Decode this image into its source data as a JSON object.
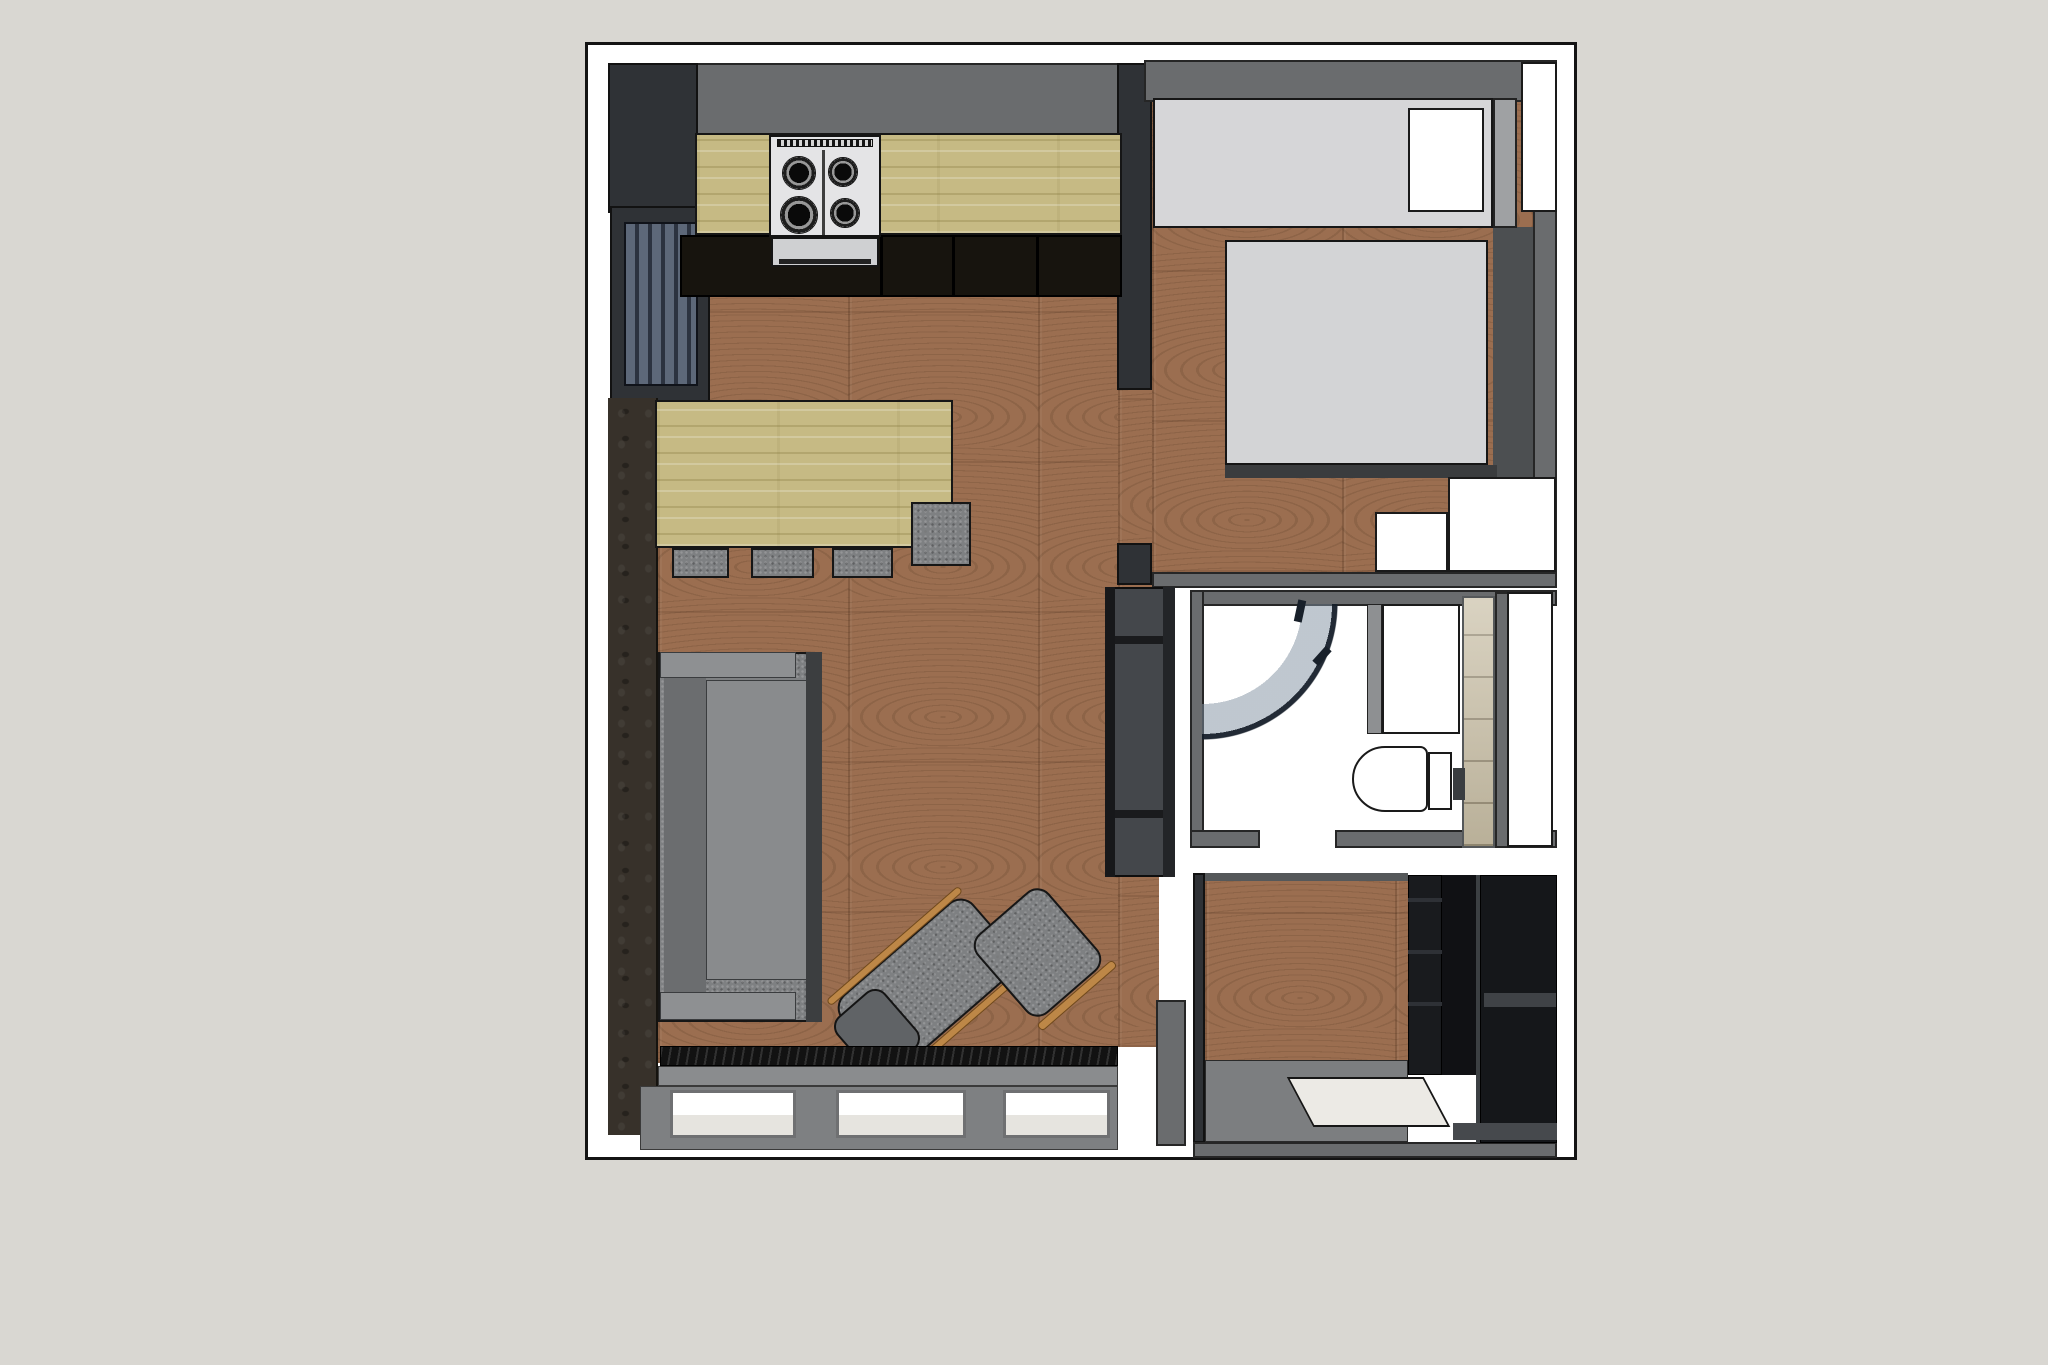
{
  "scene": {
    "kind": "apartment-floor-plan-3d-top-view",
    "rooms": [
      "kitchen",
      "living-room",
      "bedroom",
      "bathroom",
      "entry-hall"
    ],
    "furniture": [
      "kitchen-counter",
      "gas-stove",
      "dining-table",
      "stools",
      "sofa",
      "recliner-armchair",
      "ottoman",
      "tv-cabinet",
      "radiator",
      "windows",
      "closet",
      "bed",
      "nightstands",
      "shower",
      "vanity",
      "toilet",
      "shelving-unit",
      "doormat"
    ]
  },
  "canvas": {
    "width": 2048,
    "height": 1365,
    "background": "#d9d7d2"
  },
  "plan": {
    "x": 585,
    "y": 42,
    "w": 992,
    "h": 1118,
    "background": "#ffffff",
    "border": "#141414"
  },
  "palette": {
    "page_background": "#d9d7d2",
    "plan_background": "#ffffff",
    "wall_grey": "#6a6c6e",
    "wall_dark": "#2f3236",
    "floor_wood": "#9b6e50",
    "counter_wood": "#c6ba84",
    "fabric_grey": "#7e8082",
    "accent_wall_brown": "#37312a",
    "bed_grey": "#d3d4d6",
    "closet_grey": "#d6d6d8",
    "tile_beige": "#cdc4ad",
    "chair_wood_orange": "#bd8747",
    "outline_black": "#141414"
  },
  "elements": [
    {
      "name": "living-room-floor",
      "cls": "wood",
      "x": 658,
      "y": 297,
      "w": 460,
      "h": 766
    },
    {
      "name": "doorway-floor",
      "cls": "wood",
      "x": 1118,
      "y": 385,
      "w": 34,
      "h": 165
    },
    {
      "name": "doorway-floor-south",
      "cls": "wood",
      "x": 1118,
      "y": 550,
      "w": 34,
      "h": 40
    },
    {
      "name": "living-floor-entry-edge",
      "cls": "wood",
      "x": 1118,
      "y": 877,
      "w": 41,
      "h": 170
    },
    {
      "name": "bedroom-floor",
      "cls": "wood",
      "x": 1152,
      "y": 100,
      "w": 381,
      "h": 472
    },
    {
      "name": "entry-floor-wood",
      "cls": "wood",
      "x": 1205,
      "y": 878,
      "w": 203,
      "h": 186
    },
    {
      "name": "entry-floor-concrete",
      "x": 1205,
      "y": 1060,
      "w": 203,
      "h": 82,
      "fill": "#7c7e80",
      "border": "1px solid #2a2a2a"
    },
    {
      "name": "kitchen-top-wall",
      "cls": "wall",
      "x": 608,
      "y": 63,
      "w": 536,
      "h": 72
    },
    {
      "name": "kitchen-corner-wall",
      "cls": "wall-dark",
      "x": 608,
      "y": 63,
      "w": 90,
      "h": 150
    },
    {
      "name": "left-window-frame",
      "cls": "wall-dark",
      "x": 610,
      "y": 206,
      "w": 100,
      "h": 196
    },
    {
      "name": "left-window-blinds",
      "cls": "blinds",
      "x": 624,
      "y": 222,
      "w": 74,
      "h": 164
    },
    {
      "name": "accent-wall",
      "cls": "accent",
      "x": 608,
      "y": 398,
      "w": 50,
      "h": 737
    },
    {
      "name": "partition-wall-upper",
      "cls": "wall-dark",
      "x": 1117,
      "y": 63,
      "w": 35,
      "h": 327
    },
    {
      "name": "partition-wall-stub",
      "cls": "wall-dark",
      "x": 1117,
      "y": 543,
      "w": 35,
      "h": 42
    },
    {
      "name": "bedroom-top-wall",
      "cls": "wall",
      "x": 1144,
      "y": 60,
      "w": 413,
      "h": 42
    },
    {
      "name": "bedroom-right-wall",
      "cls": "wall",
      "x": 1533,
      "y": 62,
      "w": 24,
      "h": 510
    },
    {
      "name": "bedroom-bottom-wall",
      "cls": "wall",
      "x": 1152,
      "y": 572,
      "w": 405,
      "h": 16
    },
    {
      "name": "bedroom-dark-floor-strip",
      "x": 1493,
      "y": 227,
      "w": 40,
      "h": 250,
      "fill": "#4c4f51"
    },
    {
      "name": "bathroom-top-wall",
      "cls": "wall",
      "x": 1190,
      "y": 590,
      "w": 367,
      "h": 16
    },
    {
      "name": "bathroom-left-wall",
      "cls": "wall",
      "x": 1190,
      "y": 590,
      "w": 14,
      "h": 258
    },
    {
      "name": "bathroom-bottom-wall-left",
      "cls": "wall",
      "x": 1190,
      "y": 830,
      "w": 70,
      "h": 18
    },
    {
      "name": "bathroom-bottom-wall-right",
      "cls": "wall",
      "x": 1335,
      "y": 830,
      "w": 222,
      "h": 18
    },
    {
      "name": "bathroom-right-sliver",
      "cls": "wall",
      "x": 1495,
      "y": 592,
      "w": 14,
      "h": 256
    },
    {
      "name": "entry-left-wall",
      "cls": "wall-dark",
      "x": 1193,
      "y": 873,
      "w": 12,
      "h": 270
    },
    {
      "name": "entry-top-wall",
      "x": 1205,
      "y": 873,
      "w": 203,
      "h": 8,
      "fill": "#55585a"
    },
    {
      "name": "entry-bottom-wall",
      "cls": "wall",
      "x": 1193,
      "y": 1142,
      "w": 364,
      "h": 16
    },
    {
      "name": "living-corner-wall",
      "cls": "wall",
      "x": 1156,
      "y": 1000,
      "w": 30,
      "h": 146
    },
    {
      "name": "kitchen-base-cabinets",
      "x": 680,
      "y": 235,
      "w": 442,
      "h": 62,
      "fill": "#17140e",
      "border": "2px solid #000"
    },
    {
      "name": "cabinet-divider-1",
      "x": 880,
      "y": 237,
      "w": 3,
      "h": 58,
      "fill": "#000"
    },
    {
      "name": "cabinet-divider-2",
      "x": 952,
      "y": 237,
      "w": 3,
      "h": 58,
      "fill": "#000"
    },
    {
      "name": "cabinet-divider-3",
      "x": 1036,
      "y": 237,
      "w": 3,
      "h": 58,
      "fill": "#000"
    },
    {
      "name": "kitchen-counter",
      "cls": "wood-light",
      "x": 695,
      "y": 133,
      "w": 427,
      "h": 102
    },
    {
      "name": "gas-stove",
      "x": 769,
      "y": 135,
      "w": 112,
      "h": 102,
      "fill": "#e4e4e6",
      "border": "2px solid #141414"
    },
    {
      "name": "stove-vent-strip",
      "cls": "vent",
      "x": 777,
      "y": 139,
      "w": 96,
      "h": 8
    },
    {
      "name": "burner-top-left",
      "cls": "burner",
      "x": 782,
      "y": 156,
      "w": 34,
      "h": 34
    },
    {
      "name": "burner-top-right",
      "cls": "burner",
      "x": 828,
      "y": 157,
      "w": 30,
      "h": 30
    },
    {
      "name": "burner-bottom-left",
      "cls": "burner",
      "x": 780,
      "y": 196,
      "w": 38,
      "h": 38
    },
    {
      "name": "burner-bottom-right",
      "cls": "burner",
      "x": 830,
      "y": 198,
      "w": 30,
      "h": 30
    },
    {
      "name": "stove-grate-divider",
      "x": 822,
      "y": 150,
      "w": 3,
      "h": 86,
      "fill": "rgba(20,20,20,0.8)"
    },
    {
      "name": "oven-front",
      "x": 771,
      "y": 237,
      "w": 108,
      "h": 30,
      "fill": "#cfd0d2",
      "border": "2px solid #141414"
    },
    {
      "name": "oven-handle",
      "x": 779,
      "y": 259,
      "w": 92,
      "h": 5,
      "fill": "#222"
    },
    {
      "name": "dining-table",
      "cls": "wood-light",
      "x": 655,
      "y": 400,
      "w": 298,
      "h": 148
    },
    {
      "name": "stool-1",
      "cls": "fabric",
      "x": 672,
      "y": 548,
      "w": 57,
      "h": 30
    },
    {
      "name": "stool-2",
      "cls": "fabric",
      "x": 751,
      "y": 548,
      "w": 63,
      "h": 30
    },
    {
      "name": "stool-3",
      "cls": "fabric",
      "x": 832,
      "y": 548,
      "w": 61,
      "h": 30
    },
    {
      "name": "stool-4",
      "cls": "fabric",
      "x": 911,
      "y": 502,
      "w": 60,
      "h": 64
    },
    {
      "name": "sofa",
      "cls": "fabric",
      "x": 658,
      "y": 652,
      "w": 164,
      "h": 370
    },
    {
      "name": "sofa-back-cushion",
      "x": 664,
      "y": 662,
      "w": 42,
      "h": 348,
      "fill": "#6b6d6f"
    },
    {
      "name": "sofa-seat",
      "x": 706,
      "y": 680,
      "w": 104,
      "h": 300,
      "fill": "#898b8d",
      "border": "1px solid #3a3c3e"
    },
    {
      "name": "sofa-armrest-top",
      "x": 660,
      "y": 652,
      "w": 136,
      "h": 26,
      "fill": "#8e9092",
      "border": "1px solid #3a3c3e"
    },
    {
      "name": "sofa-armrest-bottom",
      "x": 660,
      "y": 992,
      "w": 136,
      "h": 28,
      "fill": "#8e9092",
      "border": "1px solid #3a3c3e"
    },
    {
      "name": "sofa-side-shadow",
      "x": 806,
      "y": 652,
      "w": 16,
      "h": 370,
      "fill": "#3c3e40"
    },
    {
      "name": "recliner-seat",
      "cls": "fabric",
      "x": 840,
      "y": 937,
      "w": 175,
      "h": 95,
      "rot": -41,
      "radius": "18px"
    },
    {
      "name": "recliner-footrest",
      "x": 845,
      "y": 995,
      "w": 64,
      "h": 75,
      "fill": "#606366",
      "border": "2px solid #141414",
      "rot": -41,
      "radius": "14px"
    },
    {
      "name": "recliner-wood-arm-left",
      "x": 807,
      "y": 942,
      "w": 175,
      "h": 8,
      "fill": "#bd8747",
      "border": "1px solid #70491c",
      "rot": -41,
      "radius": "4px"
    },
    {
      "name": "recliner-wood-arm-right",
      "x": 875,
      "y": 1020,
      "w": 175,
      "h": 8,
      "fill": "#bd8747",
      "border": "1px solid #70491c",
      "rot": -41,
      "radius": "4px"
    },
    {
      "name": "ottoman",
      "cls": "fabric",
      "x": 990,
      "y": 900,
      "w": 95,
      "h": 105,
      "rot": -41,
      "radius": "16px"
    },
    {
      "name": "ottoman-wood-rim",
      "x": 1027,
      "y": 991,
      "w": 100,
      "h": 9,
      "fill": "#bd8747",
      "border": "1px solid #70491c",
      "rot": -41,
      "radius": "4px"
    },
    {
      "name": "tv-cabinet",
      "x": 1105,
      "y": 587,
      "w": 70,
      "h": 290,
      "fill": "#44474b",
      "border": "2px solid #0e0e0e"
    },
    {
      "name": "tv-cabinet-left-rail",
      "x": 1105,
      "y": 587,
      "w": 10,
      "h": 290,
      "fill": "#17181a"
    },
    {
      "name": "tv-cabinet-divider-top",
      "x": 1115,
      "y": 636,
      "w": 60,
      "h": 8,
      "fill": "#1a1b1d"
    },
    {
      "name": "tv-cabinet-divider-bottom",
      "x": 1115,
      "y": 810,
      "w": 60,
      "h": 8,
      "fill": "#1a1b1d"
    },
    {
      "name": "tv-cabinet-right-trim",
      "x": 1163,
      "y": 587,
      "w": 12,
      "h": 290,
      "fill": "#232528"
    },
    {
      "name": "radiator-grille",
      "cls": "radiator",
      "x": 660,
      "y": 1046,
      "w": 458,
      "h": 20
    },
    {
      "name": "window-sill",
      "x": 658,
      "y": 1066,
      "w": 460,
      "h": 20,
      "fill": "#8a8c8e",
      "border": "1px solid #3a3a3a"
    },
    {
      "name": "window-frame-band",
      "x": 640,
      "y": 1086,
      "w": 478,
      "h": 64,
      "fill": "#7e8082",
      "border": "1px solid #3a3a3a"
    },
    {
      "name": "window-pane-1",
      "cls": "pane",
      "x": 670,
      "y": 1090,
      "w": 126,
      "h": 48
    },
    {
      "name": "window-pane-2",
      "cls": "pane",
      "x": 836,
      "y": 1090,
      "w": 130,
      "h": 48
    },
    {
      "name": "window-pane-3",
      "cls": "pane",
      "x": 1003,
      "y": 1090,
      "w": 107,
      "h": 48
    },
    {
      "name": "closet",
      "x": 1153,
      "y": 98,
      "w": 340,
      "h": 130,
      "fill": "#d6d6d8",
      "border": "2px solid #161616"
    },
    {
      "name": "closet-door-white",
      "cls": "white-box",
      "x": 1408,
      "y": 108,
      "w": 76,
      "h": 104
    },
    {
      "name": "closet-side-cap",
      "x": 1493,
      "y": 98,
      "w": 24,
      "h": 130,
      "fill": "#9fa1a3",
      "border": "2px solid #222"
    },
    {
      "name": "open-door-panel",
      "cls": "white-box",
      "x": 1521,
      "y": 62,
      "w": 36,
      "h": 150
    },
    {
      "name": "bed",
      "x": 1225,
      "y": 240,
      "w": 263,
      "h": 225,
      "fill": "#d3d4d6",
      "border": "2px solid #161616"
    },
    {
      "name": "bed-foot-rail",
      "x": 1225,
      "y": 465,
      "w": 272,
      "h": 13,
      "fill": "#3a3c3e"
    },
    {
      "name": "nightstand-large",
      "cls": "white-box",
      "x": 1448,
      "y": 477,
      "w": 108,
      "h": 95
    },
    {
      "name": "nightstand-small",
      "cls": "white-box",
      "x": 1375,
      "y": 512,
      "w": 73,
      "h": 60
    },
    {
      "name": "shower-glass-arc",
      "cls": "glass-arc",
      "x": 1202,
      "y": 604,
      "w": 150,
      "h": 150
    },
    {
      "name": "shower-hinge-1",
      "x": 1296,
      "y": 600,
      "w": 8,
      "h": 22,
      "fill": "#18202a",
      "rot": 12
    },
    {
      "name": "shower-hinge-2",
      "x": 1318,
      "y": 646,
      "w": 8,
      "h": 20,
      "fill": "#18202a",
      "rot": 42
    },
    {
      "name": "vanity-side-panel",
      "x": 1367,
      "y": 604,
      "w": 15,
      "h": 130,
      "fill": "#8e9092",
      "border": "1px solid #222"
    },
    {
      "name": "vanity-cabinet",
      "cls": "white-box",
      "x": 1382,
      "y": 604,
      "w": 78,
      "h": 130
    },
    {
      "name": "bathroom-tile-wall",
      "cls": "tiles",
      "x": 1462,
      "y": 596,
      "w": 33,
      "h": 252
    },
    {
      "name": "flush-plate",
      "x": 1453,
      "y": 768,
      "w": 12,
      "h": 32,
      "fill": "#3a3d40"
    },
    {
      "name": "toilet-tank",
      "cls": "white-box",
      "x": 1428,
      "y": 752,
      "w": 24,
      "h": 58
    },
    {
      "name": "toilet-bowl",
      "cls": "white-box",
      "x": 1352,
      "y": 746,
      "w": 76,
      "h": 66,
      "radius": "34px 8px 8px 34px"
    },
    {
      "name": "bathroom-niche",
      "cls": "white-box",
      "x": 1507,
      "y": 592,
      "w": 46,
      "h": 255
    },
    {
      "name": "shelving-left-column",
      "x": 1408,
      "y": 875,
      "w": 34,
      "h": 200,
      "fill": "#191b1e",
      "border": "1px solid #000"
    },
    {
      "name": "shelving-shelf-line-1",
      "x": 1408,
      "y": 898,
      "w": 34,
      "h": 4,
      "fill": "#2e3136"
    },
    {
      "name": "shelving-shelf-line-2",
      "x": 1408,
      "y": 950,
      "w": 34,
      "h": 4,
      "fill": "#2e3136"
    },
    {
      "name": "shelving-shelf-line-3",
      "x": 1408,
      "y": 1002,
      "w": 34,
      "h": 4,
      "fill": "#2e3136"
    },
    {
      "name": "shelving-mid-column",
      "x": 1442,
      "y": 875,
      "w": 38,
      "h": 200,
      "fill": "#101114"
    },
    {
      "name": "shelving-right-column",
      "x": 1480,
      "y": 875,
      "w": 77,
      "h": 268,
      "fill": "#15171a",
      "border": "1px solid #000"
    },
    {
      "name": "shelving-edge-highlight",
      "x": 1476,
      "y": 875,
      "w": 4,
      "h": 268,
      "fill": "#3c4043"
    },
    {
      "name": "shelving-shelf-mid",
      "x": 1484,
      "y": 993,
      "w": 72,
      "h": 14,
      "fill": "#3f4246"
    },
    {
      "name": "shelving-shelf-bottom",
      "x": 1453,
      "y": 1123,
      "w": 104,
      "h": 17,
      "fill": "#46494d"
    },
    {
      "name": "entry-doormat",
      "cls": "mat",
      "x": 1300,
      "y": 1077,
      "w": 137,
      "h": 50,
      "skew": 28
    }
  ]
}
